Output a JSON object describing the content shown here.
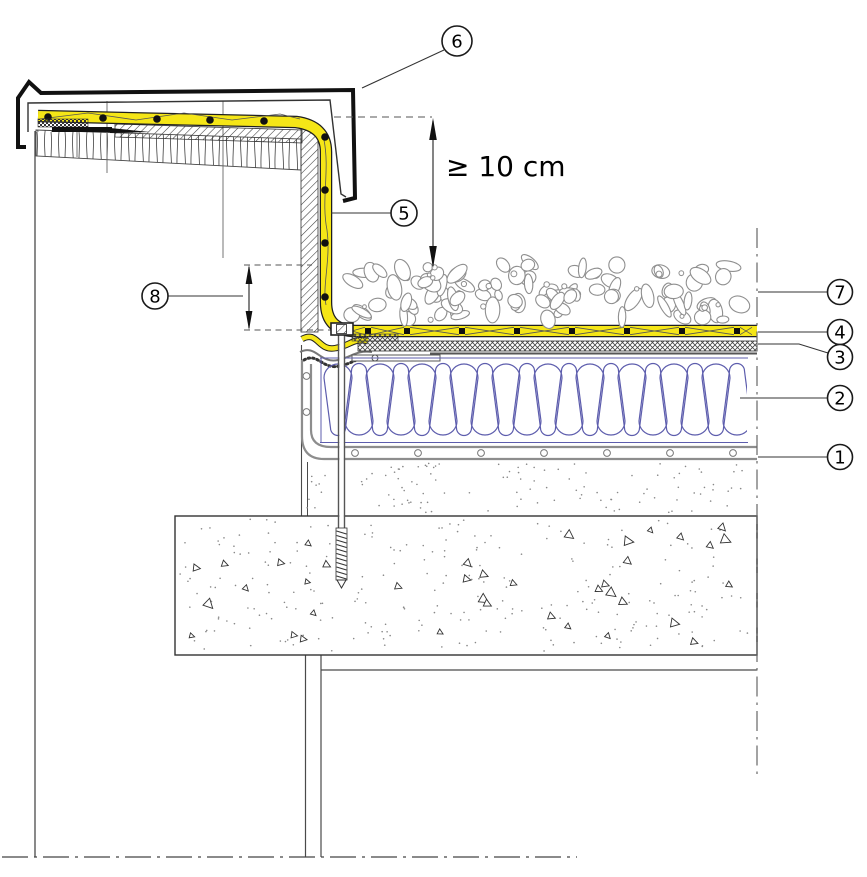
{
  "callouts": {
    "1": {
      "label": "1"
    },
    "2": {
      "label": "2"
    },
    "3": {
      "label": "3"
    },
    "4": {
      "label": "4"
    },
    "5": {
      "label": "5"
    },
    "6": {
      "label": "6"
    },
    "7": {
      "label": "7"
    },
    "8": {
      "label": "8"
    }
  },
  "dimension": {
    "min_overlap_label": "≥ 10 cm"
  },
  "colors": {
    "membrane_yellow": "#F5E617",
    "membrane_edge": "#1f1f1f",
    "insulation_purple": "#5D5DAD",
    "gravel_gray": "#8F8F8F",
    "line_dark": "#222222",
    "line_mid": "#555555"
  }
}
